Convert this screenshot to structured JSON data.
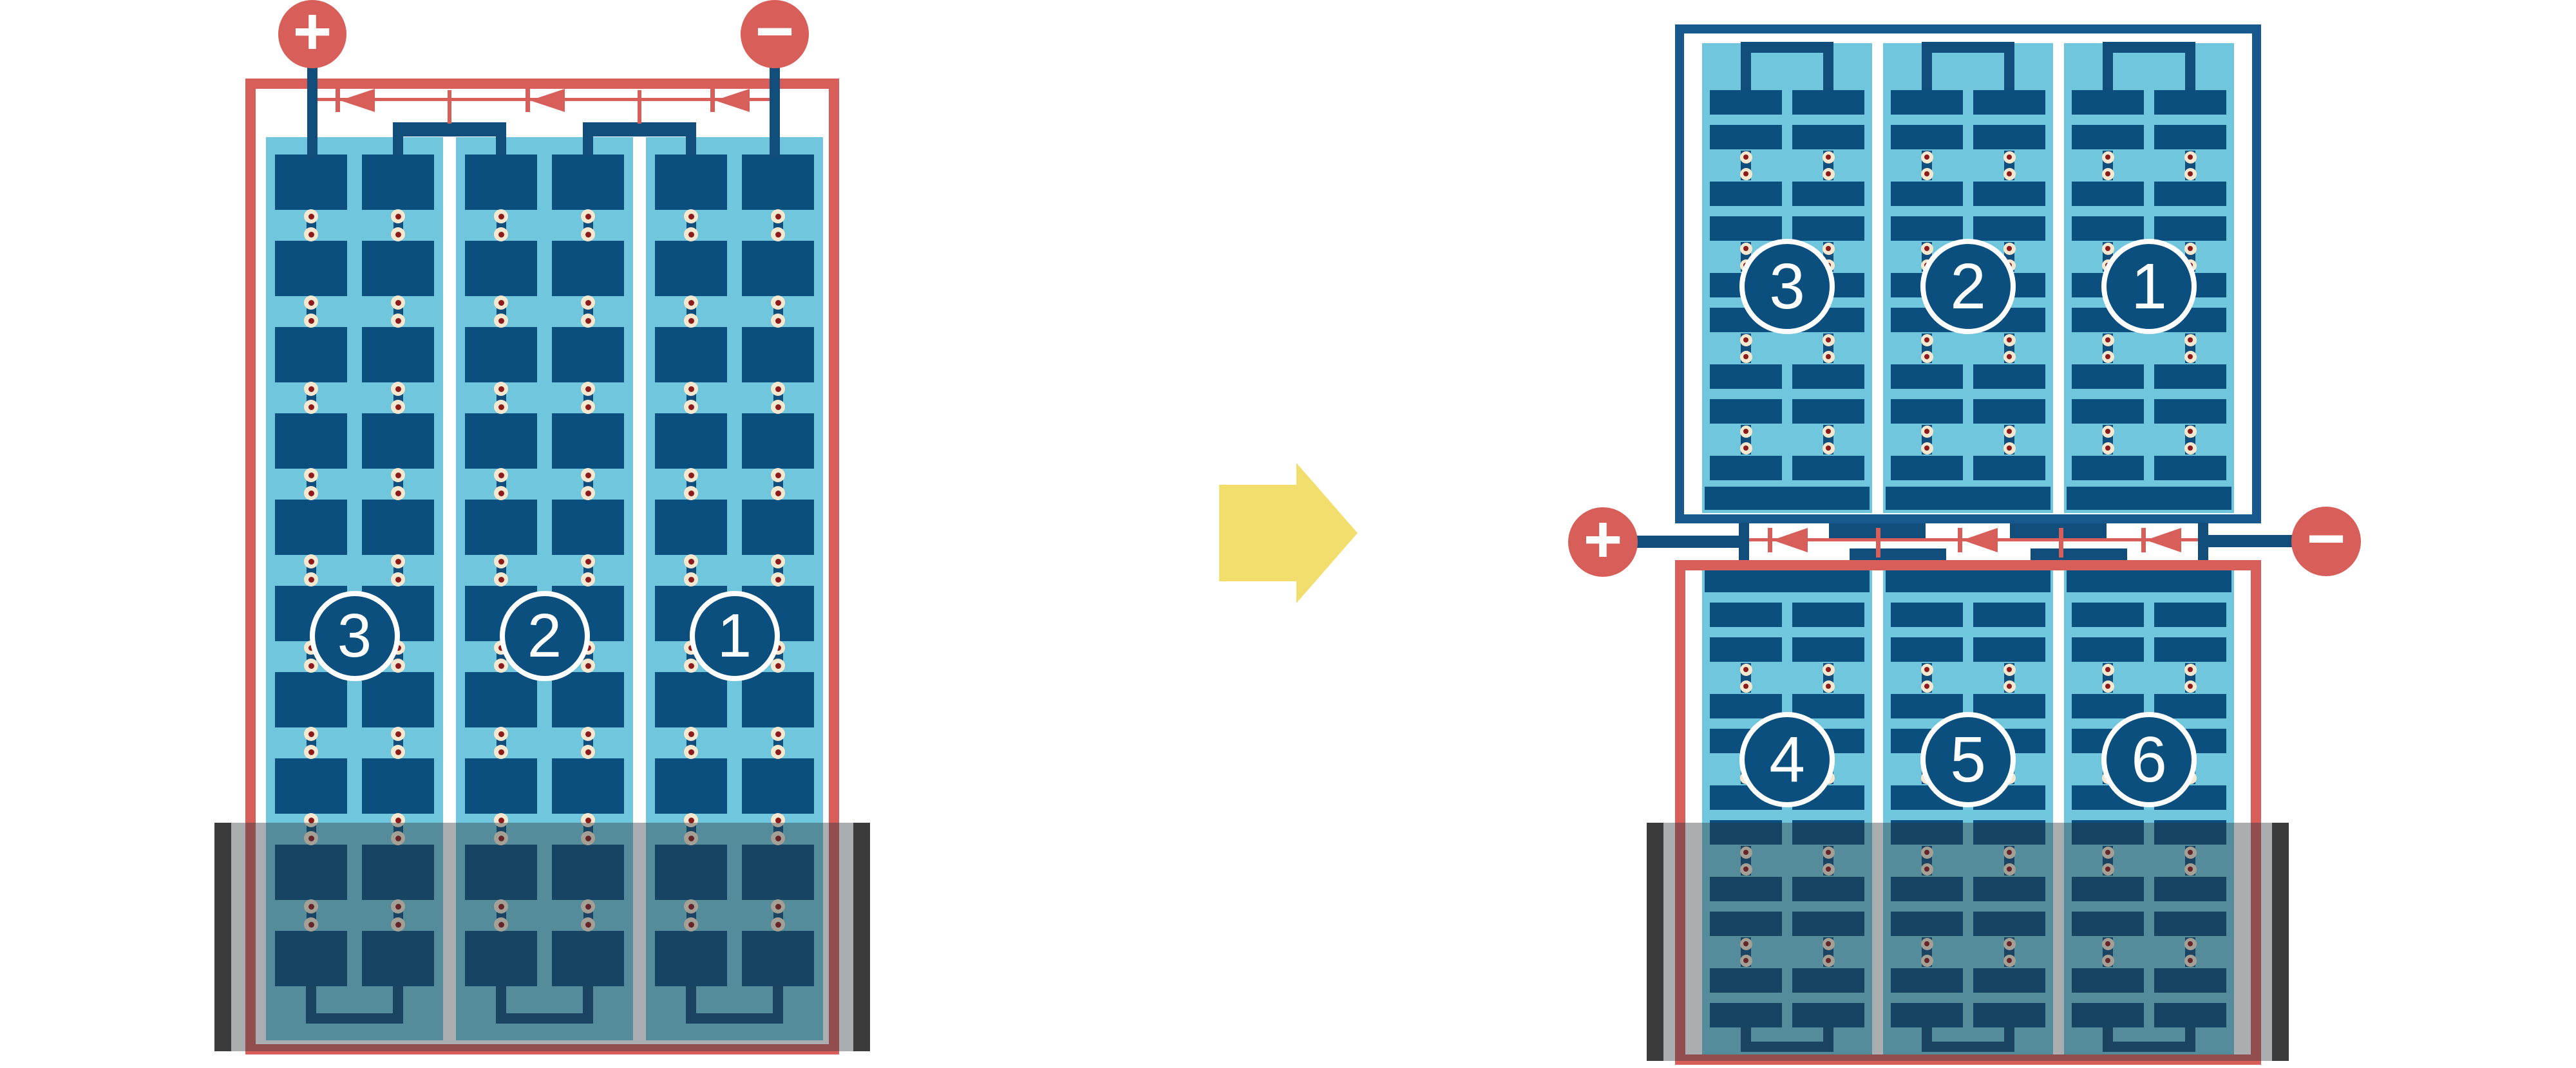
{
  "diagram": {
    "kind": "solar-module-string-wiring-comparison",
    "left_module": {
      "terminals": {
        "positive": "+",
        "negative": "−"
      },
      "cell_strings": [
        {
          "label": "3"
        },
        {
          "label": "2"
        },
        {
          "label": "1"
        }
      ],
      "bypass_diode_count": 3,
      "shaded_bottom": true
    },
    "transform_arrow": {
      "direction": "right"
    },
    "right_module": {
      "terminals": {
        "positive": "+",
        "negative": "−"
      },
      "top_half": {
        "cell_strings": [
          {
            "label": "3"
          },
          {
            "label": "2"
          },
          {
            "label": "1"
          }
        ]
      },
      "bottom_half": {
        "cell_strings": [
          {
            "label": "4"
          },
          {
            "label": "5"
          },
          {
            "label": "6"
          }
        ]
      },
      "bypass_diode_count": 3,
      "shaded_bottom": true
    }
  },
  "colors": {
    "accent_red": "#D85E5A",
    "cell_navy": "#0B4F7E",
    "wire_navy": "#114E7C",
    "frame_blue": "#17598C",
    "light_blue": "#70C6DC",
    "solder_cream": "#F5E8D0",
    "solder_red": "#8E1B1B",
    "shade_cap_gray": "#3B3B3B",
    "shade_overlay": "rgba(43,53,59,0.40)",
    "arrow_yellow": "#F2DE6D",
    "background": "#FFFFFF"
  }
}
